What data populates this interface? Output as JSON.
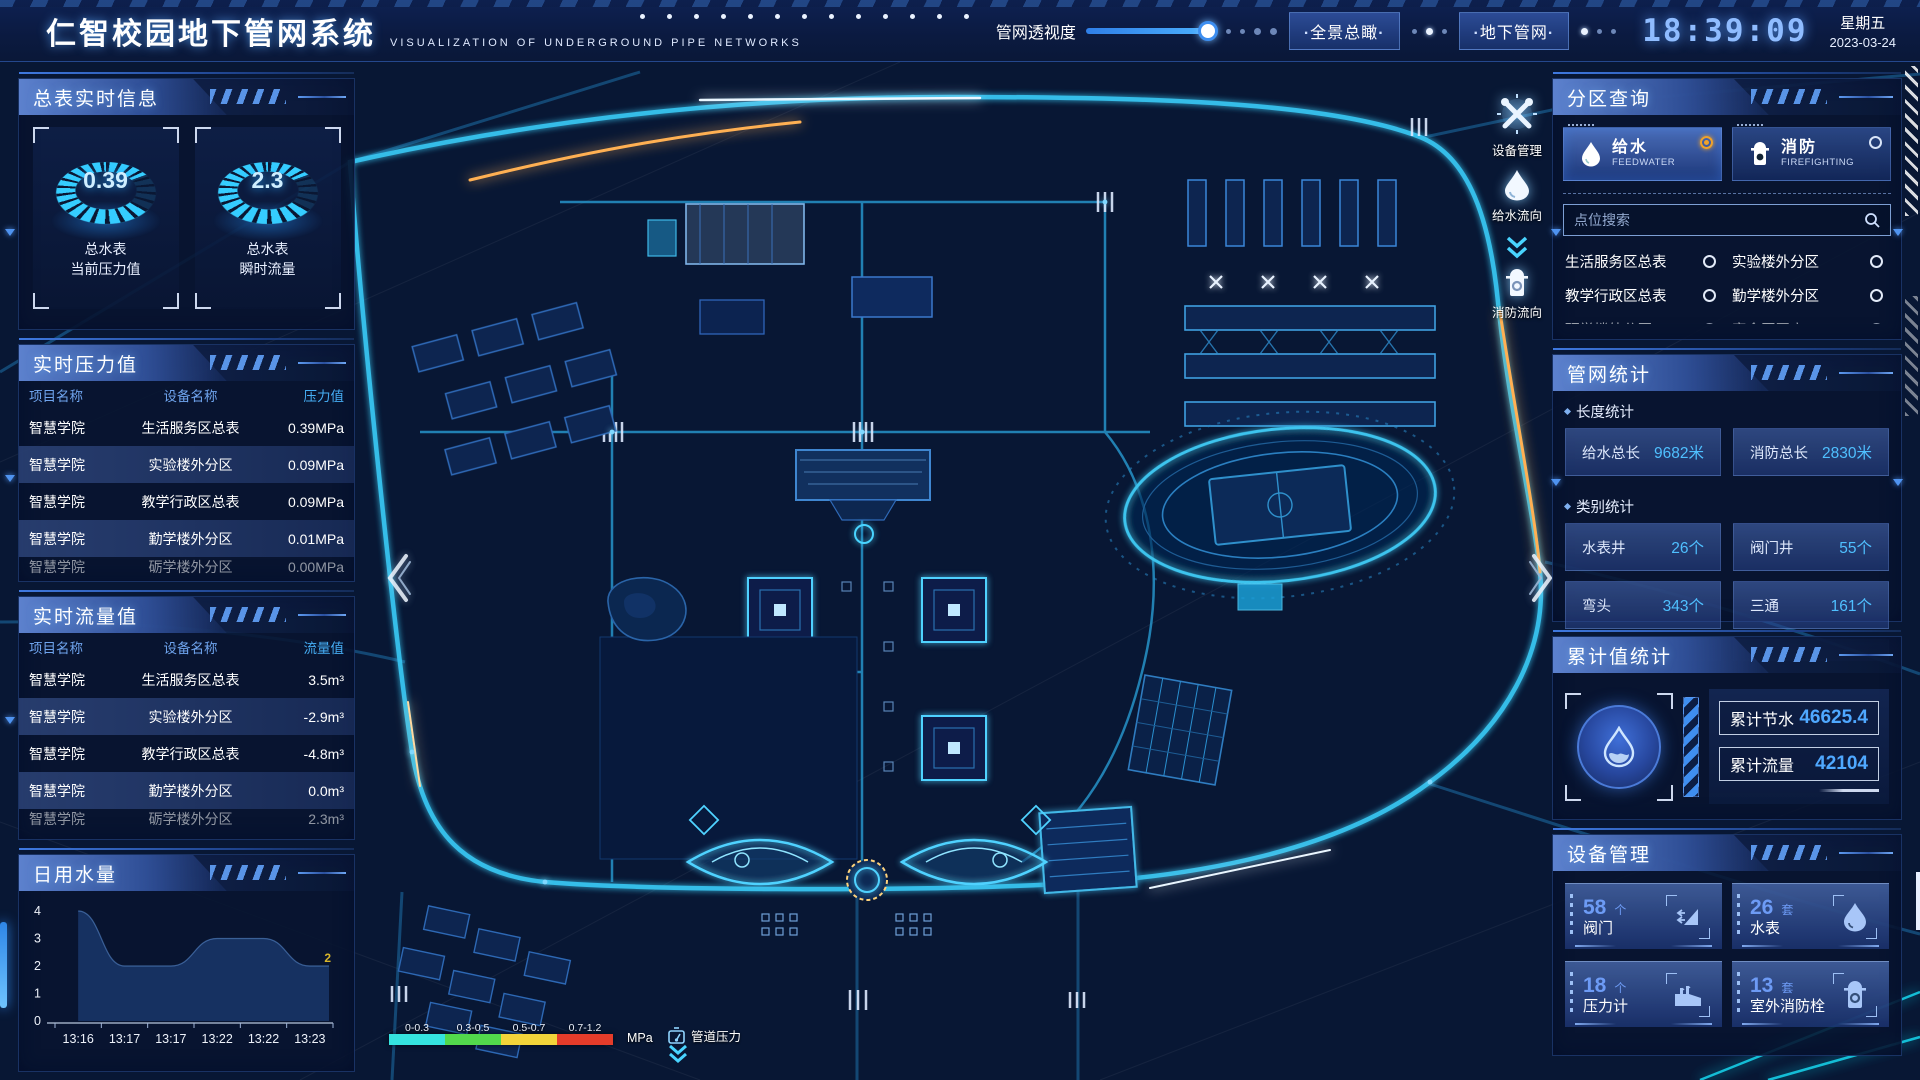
{
  "header": {
    "title": "仁智校园地下管网系统",
    "subtitle": "VISUALIZATION OF UNDERGROUND PIPE NETWORKS",
    "transparency_label": "管网透视度",
    "btn_overview": "全景总瞰",
    "btn_underground": "地下管网",
    "clock": "18:39:09",
    "weekday": "星期五",
    "date": "2023-03-24"
  },
  "left": {
    "meter_panel": {
      "title": "总表实时信息",
      "gauges": [
        {
          "value": "0.39",
          "line1": "总水表",
          "line2": "当前压力值"
        },
        {
          "value": "2.3",
          "line1": "总水表",
          "line2": "瞬时流量"
        }
      ]
    },
    "pressure_panel": {
      "title": "实时压力值",
      "columns": [
        "项目名称",
        "设备名称",
        "压力值"
      ],
      "rows": [
        [
          "智慧学院",
          "生活服务区总表",
          "0.39MPa"
        ],
        [
          "智慧学院",
          "实验楼外分区",
          "0.09MPa"
        ],
        [
          "智慧学院",
          "教学行政区总表",
          "0.09MPa"
        ],
        [
          "智慧学院",
          "勤学楼外分区",
          "0.01MPa"
        ],
        [
          "智慧学院",
          "砺学楼外分区",
          "0.00MPa"
        ]
      ]
    },
    "flow_panel": {
      "title": "实时流量值",
      "columns": [
        "项目名称",
        "设备名称",
        "流量值"
      ],
      "rows": [
        [
          "智慧学院",
          "生活服务区总表",
          "3.5m³"
        ],
        [
          "智慧学院",
          "实验楼外分区",
          "-2.9m³"
        ],
        [
          "智慧学院",
          "教学行政区总表",
          "-4.8m³"
        ],
        [
          "智慧学院",
          "勤学楼外分区",
          "0.0m³"
        ],
        [
          "智慧学院",
          "砺学楼外分区",
          "2.3m³"
        ]
      ]
    },
    "daily_panel": {
      "title": "日用水量"
    }
  },
  "chart_data": {
    "type": "area",
    "title": "日用水量",
    "x": [
      "13:16",
      "13:17",
      "13:17",
      "13:22",
      "13:22",
      "13:23"
    ],
    "values": [
      4,
      2,
      2,
      3,
      3,
      2
    ],
    "ylim": [
      0,
      4
    ],
    "yticks": [
      0,
      1,
      2,
      3,
      4
    ],
    "end_label": "2",
    "grid": false,
    "fill_color": "#1a3a6e",
    "end_label_color": "#d9b62a"
  },
  "right": {
    "zone_panel": {
      "title": "分区查询",
      "tabs": [
        {
          "label": "给水",
          "sub": "FEEDWATER",
          "selected": true
        },
        {
          "label": "消防",
          "sub": "FIREFIGHTING",
          "selected": false
        }
      ],
      "search_placeholder": "点位搜索",
      "items": [
        "生活服务区总表",
        "实验楼外分区",
        "教学行政区总表",
        "勤学楼外分区",
        "砺学楼外分区",
        "宿舍区泵房"
      ]
    },
    "stats_panel": {
      "title": "管网统计",
      "length_label": "长度统计",
      "length_stats": [
        {
          "label": "给水总长",
          "value": "9682米"
        },
        {
          "label": "消防总长",
          "value": "2830米"
        }
      ],
      "category_label": "类别统计",
      "category_stats": [
        {
          "label": "水表井",
          "value": "26个"
        },
        {
          "label": "阀门井",
          "value": "55个"
        },
        {
          "label": "弯头",
          "value": "343个"
        },
        {
          "label": "三通",
          "value": "161个"
        }
      ]
    },
    "cumulative_panel": {
      "title": "累计值统计",
      "rows": [
        {
          "label": "累计节水",
          "value": "46625.4"
        },
        {
          "label": "累计流量",
          "value": "42104"
        }
      ]
    },
    "device_panel": {
      "title": "设备管理",
      "cards": [
        {
          "count": "58",
          "unit": "个",
          "label": "阀门",
          "icon": "valve-icon"
        },
        {
          "count": "26",
          "unit": "套",
          "label": "水表",
          "icon": "water-meter-icon"
        },
        {
          "count": "18",
          "unit": "个",
          "label": "压力计",
          "icon": "pressure-gauge-icon"
        },
        {
          "count": "13",
          "unit": "套",
          "label": "室外消防栓",
          "icon": "outdoor-hydrant-icon"
        }
      ]
    }
  },
  "map": {
    "tools": [
      {
        "label": "设备管理",
        "icon": "tools-icon"
      },
      {
        "label": "给水流向",
        "icon": "water-drop-icon"
      },
      {
        "label": "消防流向",
        "icon": "hydrant-icon"
      }
    ],
    "legend": {
      "title": "管道压力",
      "unit": "MPa",
      "ranges": [
        {
          "label": "0-0.3",
          "color": "#35e3df"
        },
        {
          "label": "0.3-0.5",
          "color": "#52d94c"
        },
        {
          "label": "0.5-0.7",
          "color": "#f2d43a"
        },
        {
          "label": "0.7-1.2",
          "color": "#e53c2a"
        }
      ]
    },
    "accent_color": "#3ec7f2"
  }
}
